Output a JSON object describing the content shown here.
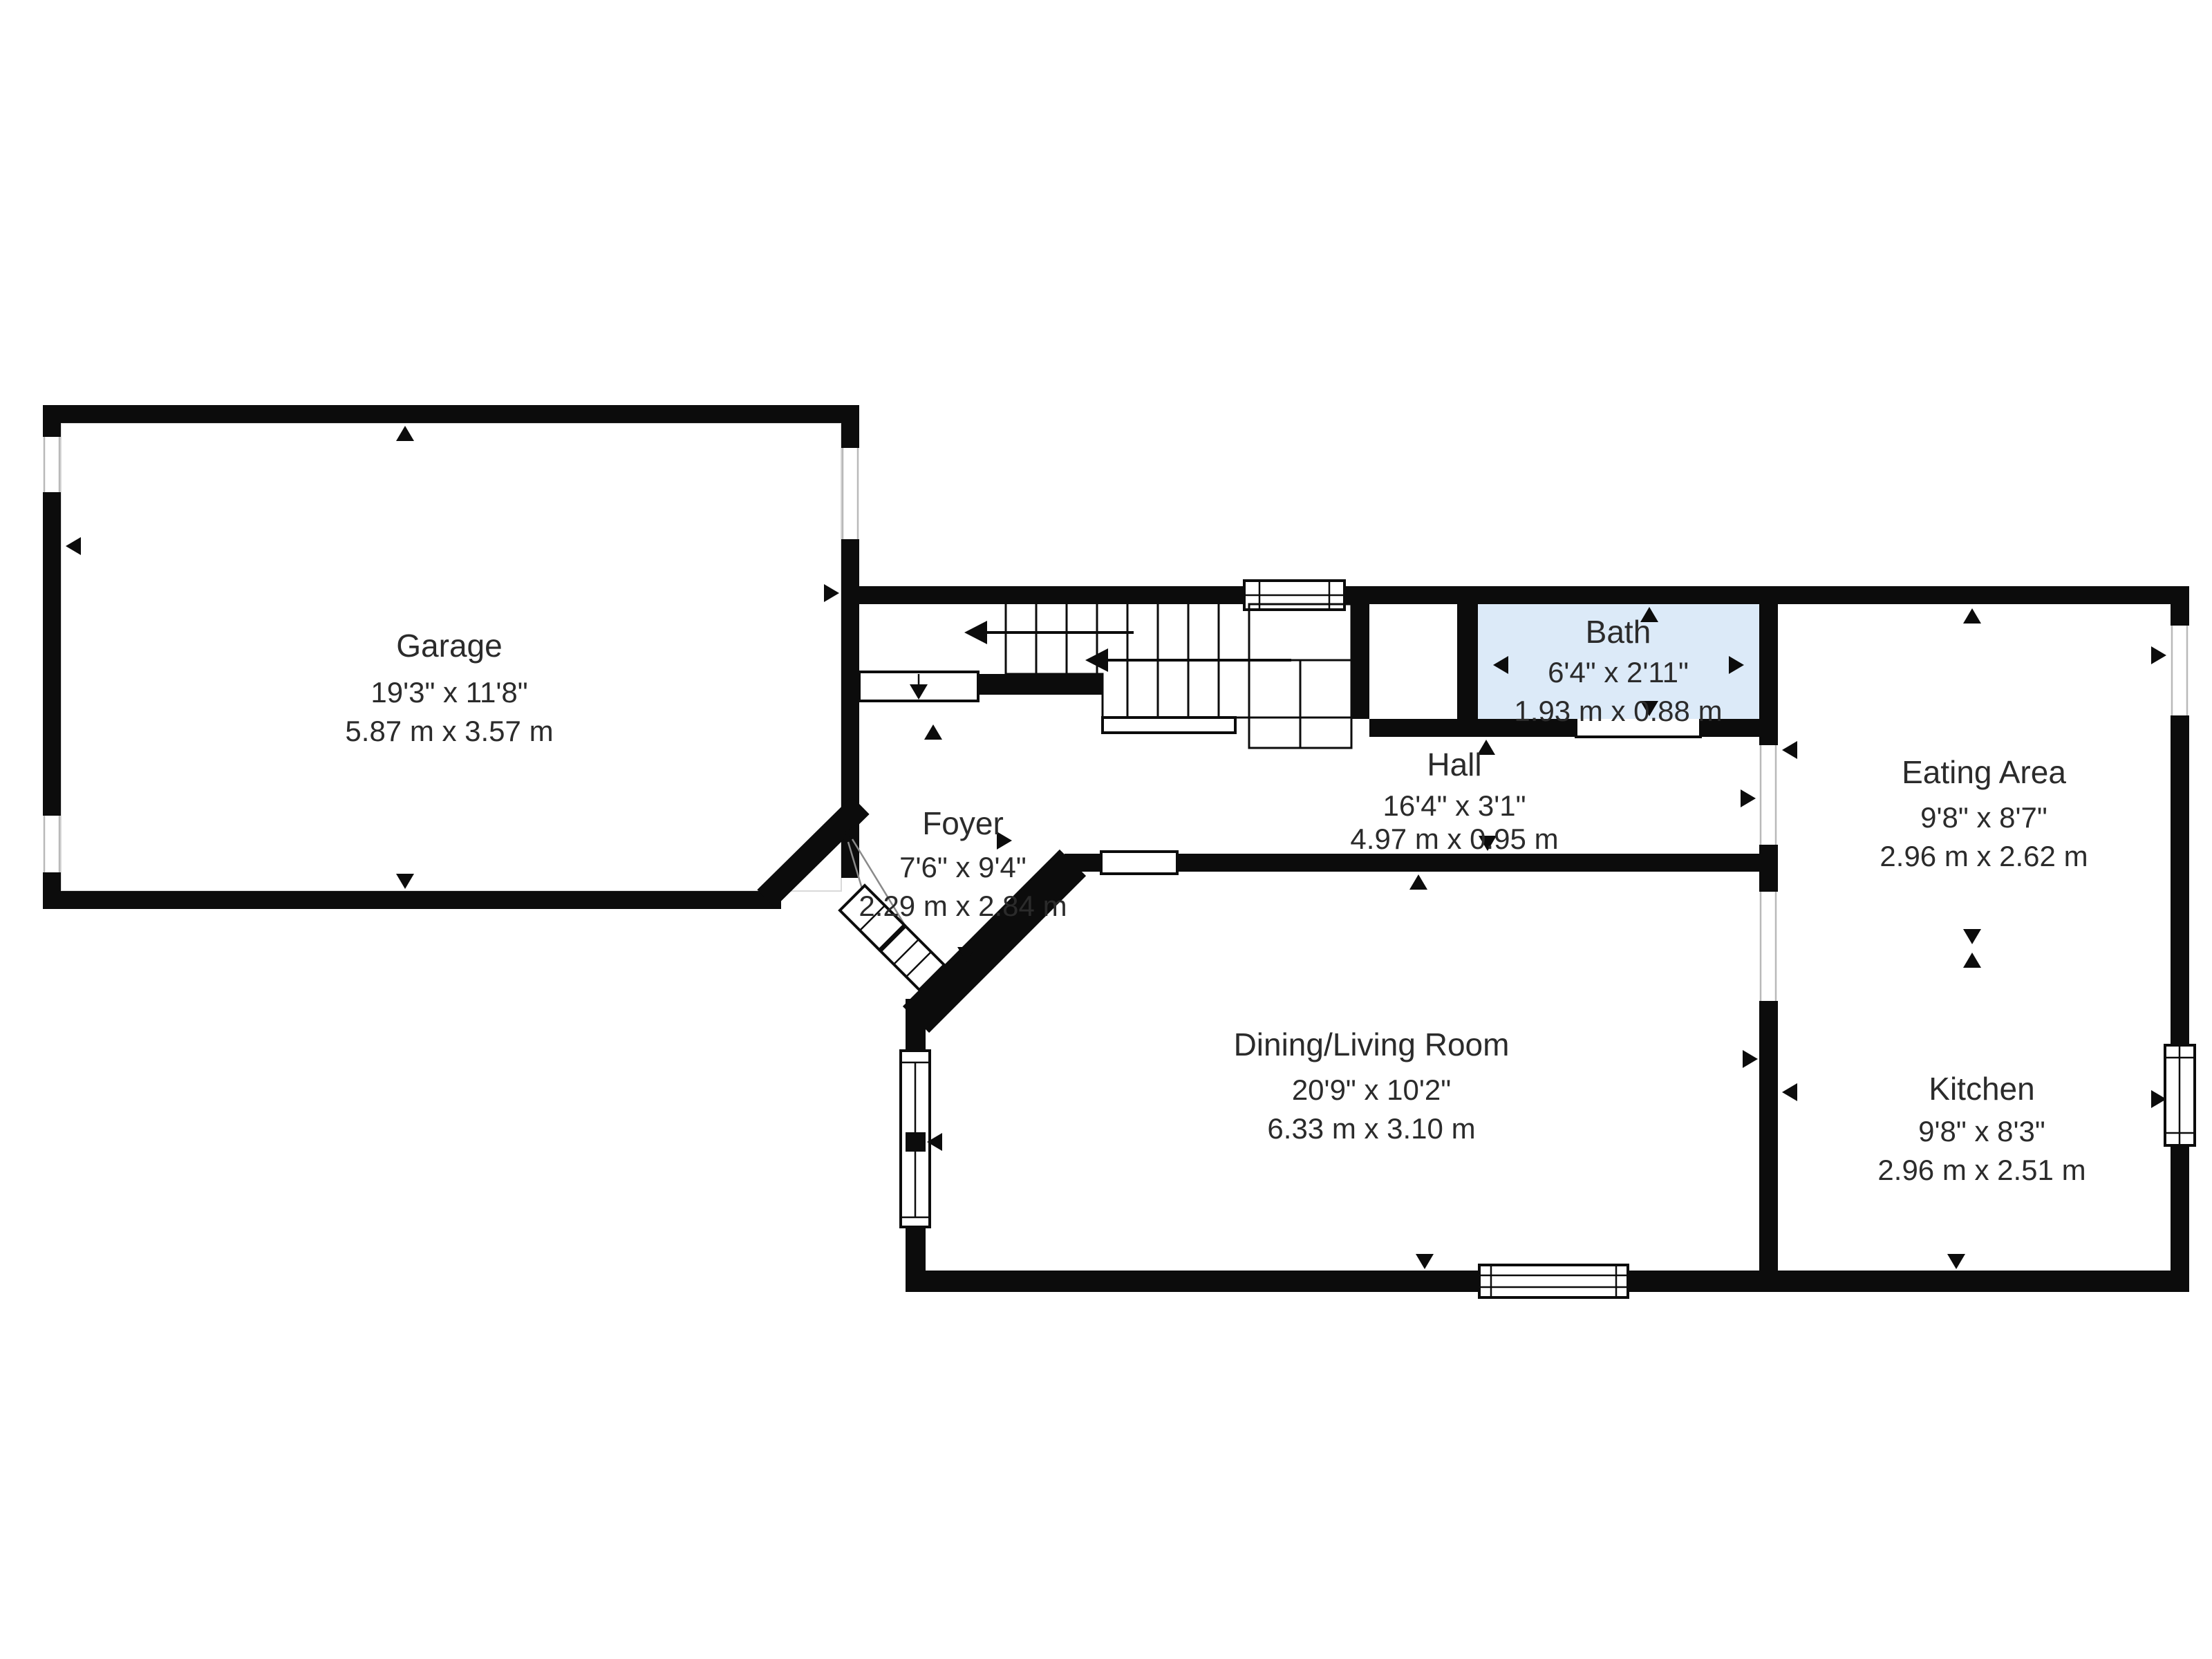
{
  "floorplan": {
    "colors": {
      "background": "#ffffff",
      "wall": "#0c0c0c",
      "bath_fill": "#dceaf8",
      "text": "#2b2b2b"
    },
    "rooms": [
      {
        "id": "garage",
        "name": "Garage",
        "imperial": "19'3\" x 11'8\"",
        "metric": "5.87 m x 3.57 m"
      },
      {
        "id": "foyer",
        "name": "Foyer",
        "imperial": "7'6\" x 9'4\"",
        "metric": "2.29 m x 2.84 m"
      },
      {
        "id": "hall",
        "name": "Hall",
        "imperial": "16'4\" x 3'1\"",
        "metric": "4.97 m x 0.95 m"
      },
      {
        "id": "bath",
        "name": "Bath",
        "imperial": "6'4\" x 2'11\"",
        "metric": "1.93 m x 0.88 m"
      },
      {
        "id": "eating-area",
        "name": "Eating Area",
        "imperial": "9'8\" x 8'7\"",
        "metric": "2.96 m x 2.62 m"
      },
      {
        "id": "dining-living-room",
        "name": "Dining/Living Room",
        "imperial": "20'9\" x 10'2\"",
        "metric": "6.33 m x 3.10 m"
      },
      {
        "id": "kitchen",
        "name": "Kitchen",
        "imperial": "9'8\" x 8'3\"",
        "metric": "2.96 m x 2.51 m"
      }
    ]
  }
}
